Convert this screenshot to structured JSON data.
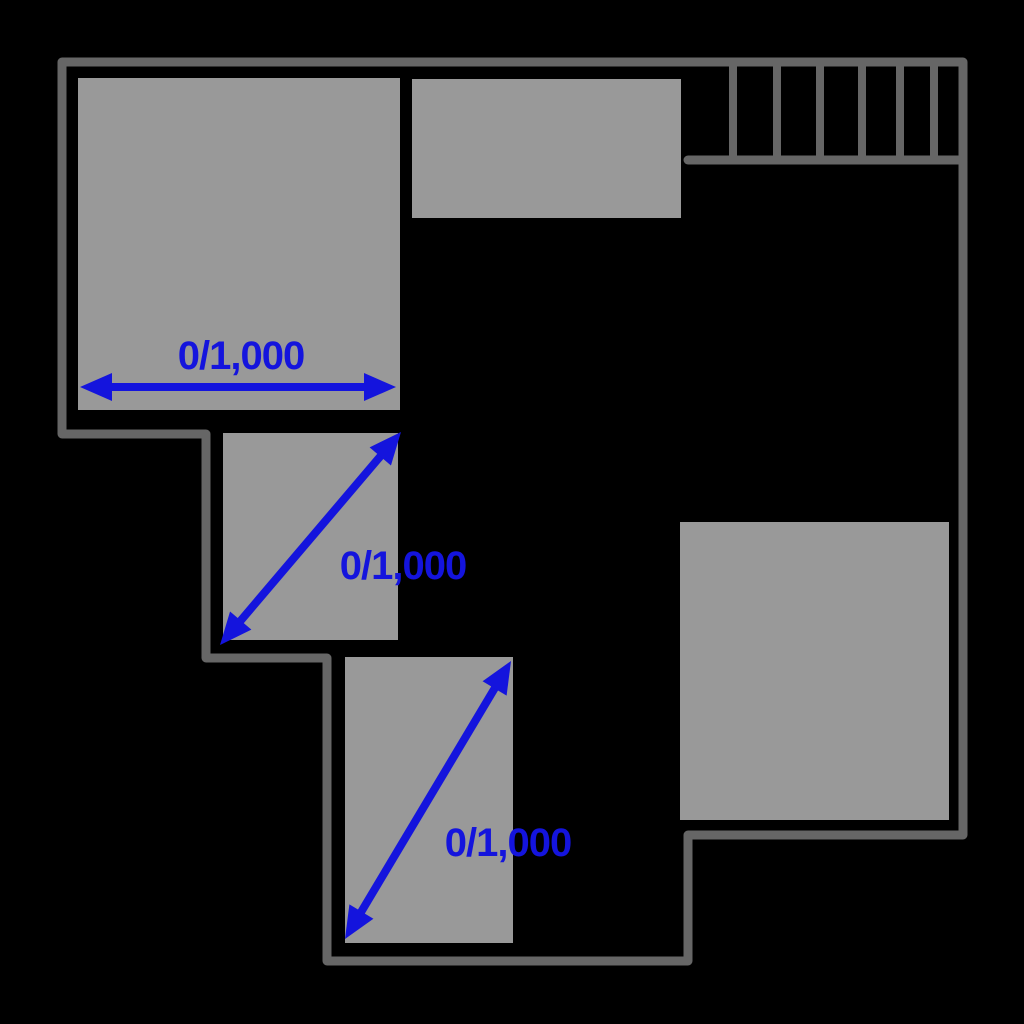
{
  "colors": {
    "background": "#000000",
    "wall": "#666666",
    "room_fill": "#999999",
    "dimension_blue": "#1414dd"
  },
  "plan": {
    "canvas": {
      "width": 1024,
      "height": 1024
    },
    "wall_thickness": 9,
    "outline_points": [
      [
        62,
        62
      ],
      [
        963,
        62
      ],
      [
        963,
        835
      ],
      [
        688,
        835
      ],
      [
        688,
        961
      ],
      [
        327,
        961
      ],
      [
        327,
        658
      ],
      [
        206,
        658
      ],
      [
        206,
        434
      ],
      [
        62,
        434
      ]
    ],
    "rooms": [
      {
        "name": "room-top-left",
        "x": 78,
        "y": 78,
        "w": 322,
        "h": 332
      },
      {
        "name": "room-top-middle",
        "x": 412,
        "y": 79,
        "w": 269,
        "h": 139
      },
      {
        "name": "room-middle",
        "x": 223,
        "y": 433,
        "w": 175,
        "h": 207
      },
      {
        "name": "room-bottom-middle",
        "x": 345,
        "y": 657,
        "w": 168,
        "h": 286
      },
      {
        "name": "room-right",
        "x": 680,
        "y": 522,
        "w": 269,
        "h": 298
      }
    ],
    "stairs": {
      "base_line": {
        "x1": 688,
        "y1": 160,
        "x2": 963,
        "y2": 160
      },
      "tread_top_y": 62,
      "tread_bottom_y": 160,
      "treads_x": [
        733,
        777,
        820,
        862,
        900,
        934
      ]
    },
    "dimensions": [
      {
        "label": "0/1,000",
        "x1": 80,
        "y1": 387,
        "x2": 396,
        "y2": 387,
        "label_cx": 241,
        "label_cy": 356
      },
      {
        "label": "0/1,000",
        "x1": 220,
        "y1": 645,
        "x2": 401,
        "y2": 432,
        "label_cx": 403,
        "label_cy": 566
      },
      {
        "label": "0/1,000",
        "x1": 345,
        "y1": 939,
        "x2": 511,
        "y2": 661,
        "label_cx": 508,
        "label_cy": 843
      }
    ],
    "arrow_style": {
      "shaft_width": 8,
      "head_length": 32,
      "head_width": 28
    }
  }
}
